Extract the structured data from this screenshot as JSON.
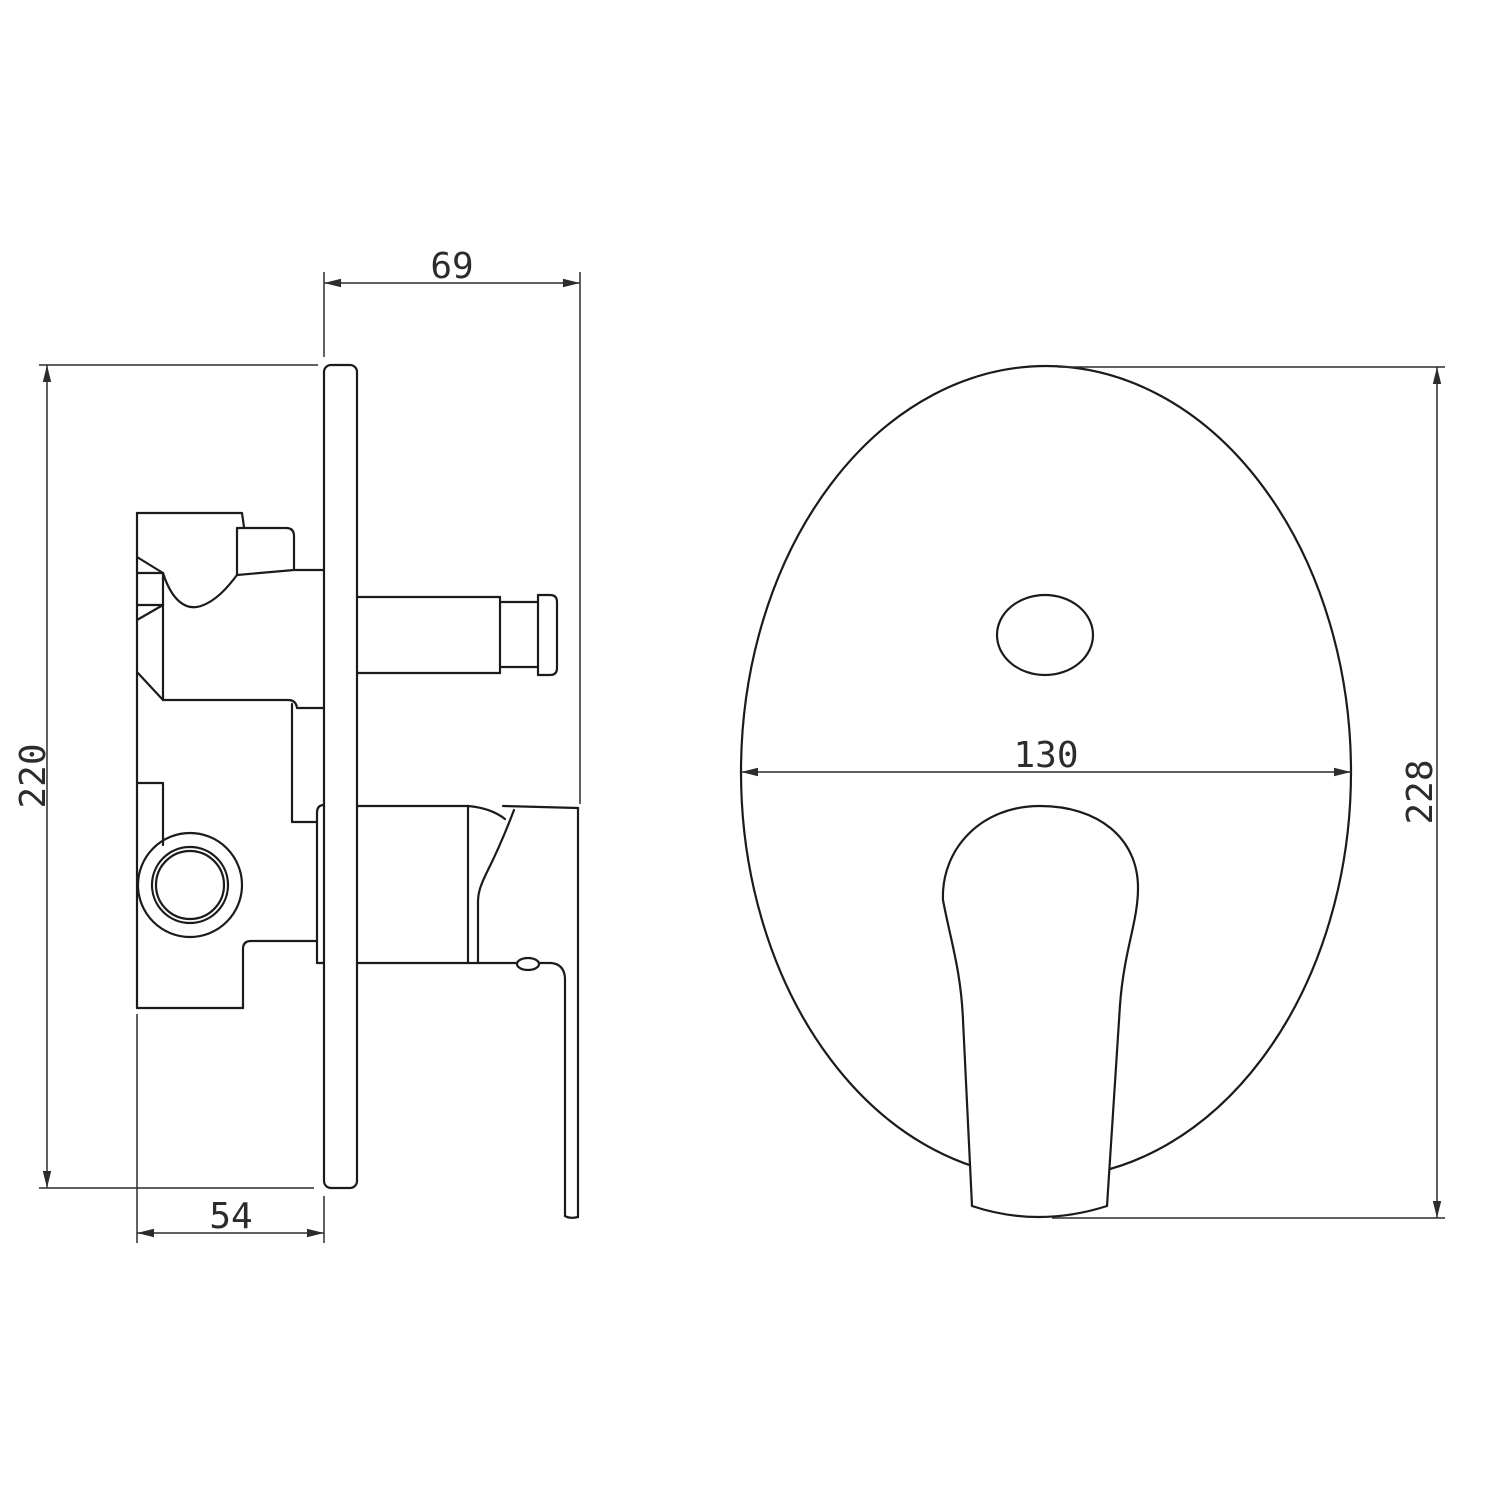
{
  "page": {
    "background_color": "#ffffff",
    "part_line_color": "#1b1b1b",
    "dimension_color": "#2c2c2c"
  },
  "views": {
    "side_view": {
      "label": "side-section-view",
      "dimensions": {
        "protrusion_from_wall": "69",
        "valve_body_height": "220",
        "recess_depth_behind_wall": "54"
      }
    },
    "front_view": {
      "label": "front-view",
      "dimensions": {
        "plate_width": "130",
        "overall_height": "228"
      }
    }
  }
}
